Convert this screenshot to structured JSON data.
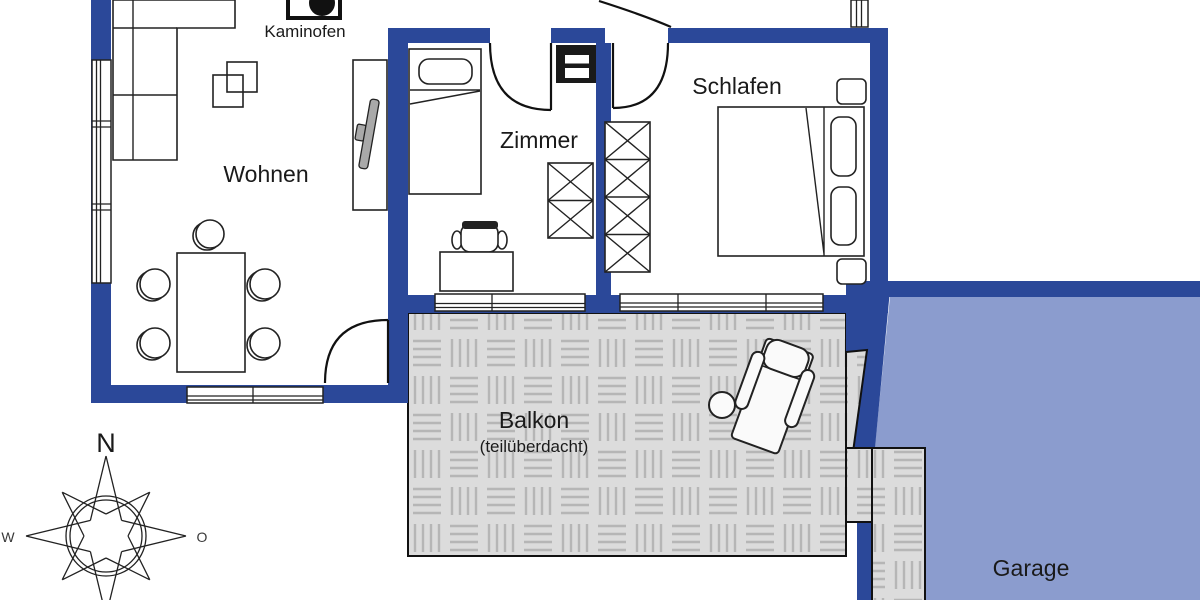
{
  "floorplan": {
    "rooms": [
      {
        "id": "wohnen",
        "label": "Wohnen"
      },
      {
        "id": "zimmer",
        "label": "Zimmer"
      },
      {
        "id": "schlafen",
        "label": "Schlafen"
      },
      {
        "id": "balkon",
        "label": "Balkon",
        "note": "(teilüberdacht)"
      },
      {
        "id": "garage",
        "label": "Garage"
      }
    ],
    "annotations": {
      "kaminofen": "Kaminofen"
    },
    "compass": {
      "north": "N",
      "west": "W",
      "east": "O"
    },
    "colors": {
      "wall_blue": "#2b4899",
      "garage_fill": "#8b9cce",
      "garage_text": "#2a3148",
      "balcony_fill": "#dcdcdc",
      "balcony_hatch": "#b6b6b6",
      "outline_black": "#1a1a1a"
    }
  }
}
